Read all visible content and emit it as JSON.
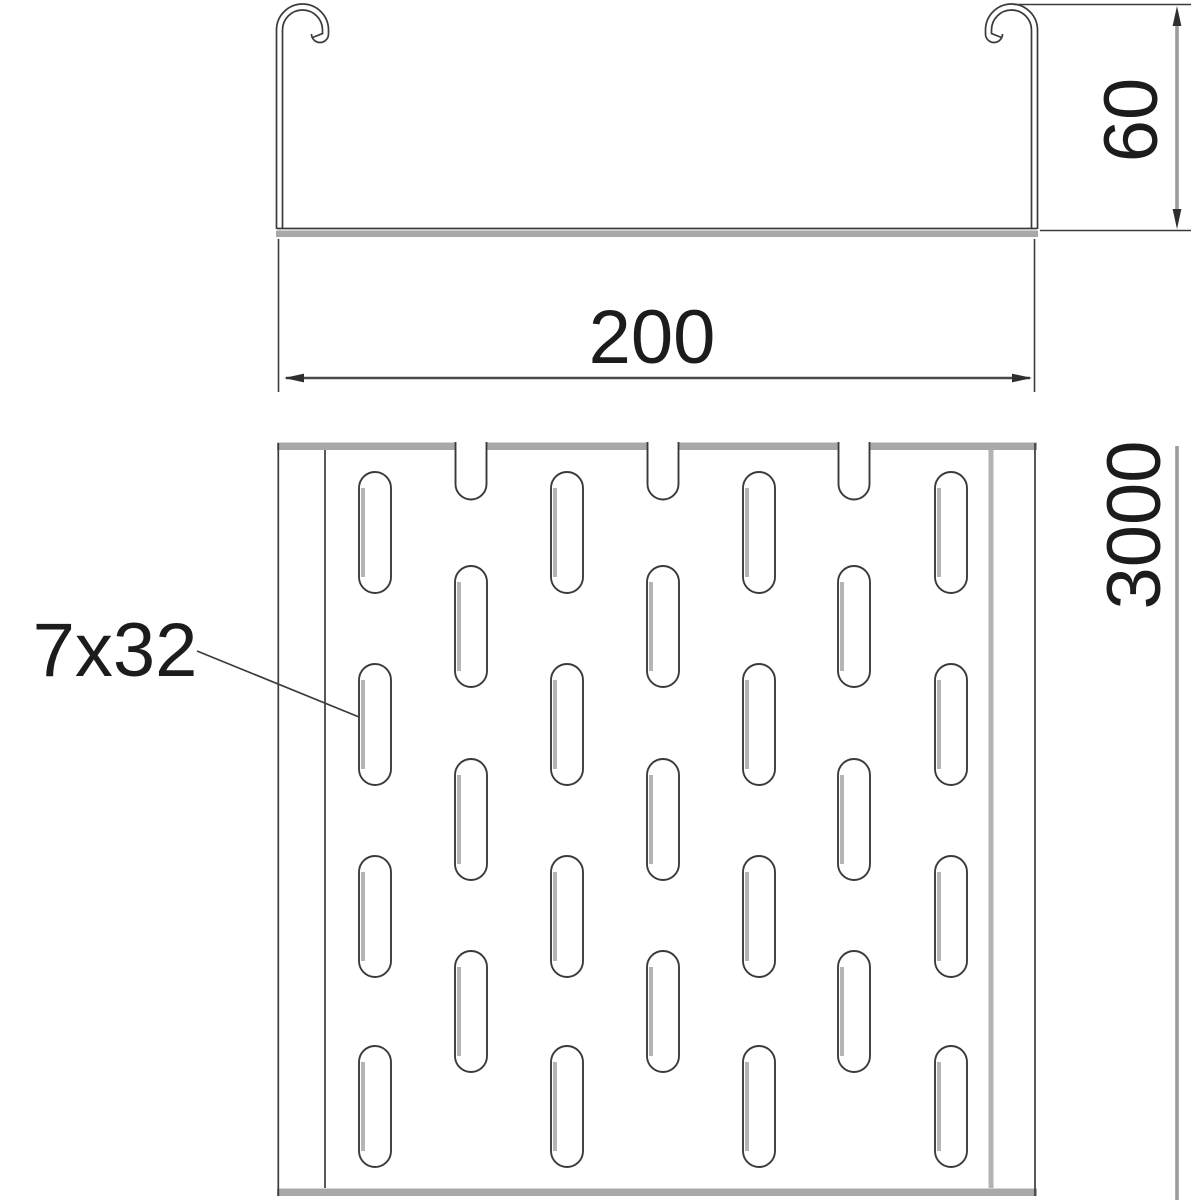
{
  "drawing": {
    "title": "Perforated cable tray technical drawing",
    "cross_section": {
      "width_label": "200",
      "height_label": "60"
    },
    "plan_view": {
      "length_label": "3000",
      "slot_label": "7x32",
      "pattern": {
        "slot_width": 32,
        "slot_height": 121,
        "odd_columns": [
          375,
          567,
          759,
          951
        ],
        "even_columns": [
          471,
          663,
          854
        ],
        "odd_rows": [
          472,
          664,
          856,
          1046
        ],
        "even_rows": [
          566,
          759,
          951
        ],
        "notch_width": 31,
        "notch_top": 442,
        "notch_straight_bottom": 484
      }
    },
    "colors": {
      "line_dark": "#3b3b3b",
      "shade_gray": "#a8a8a8",
      "dim_line_gray": "#9b9b9b",
      "text": "#1c1c1c",
      "background": "#ffffff"
    }
  }
}
